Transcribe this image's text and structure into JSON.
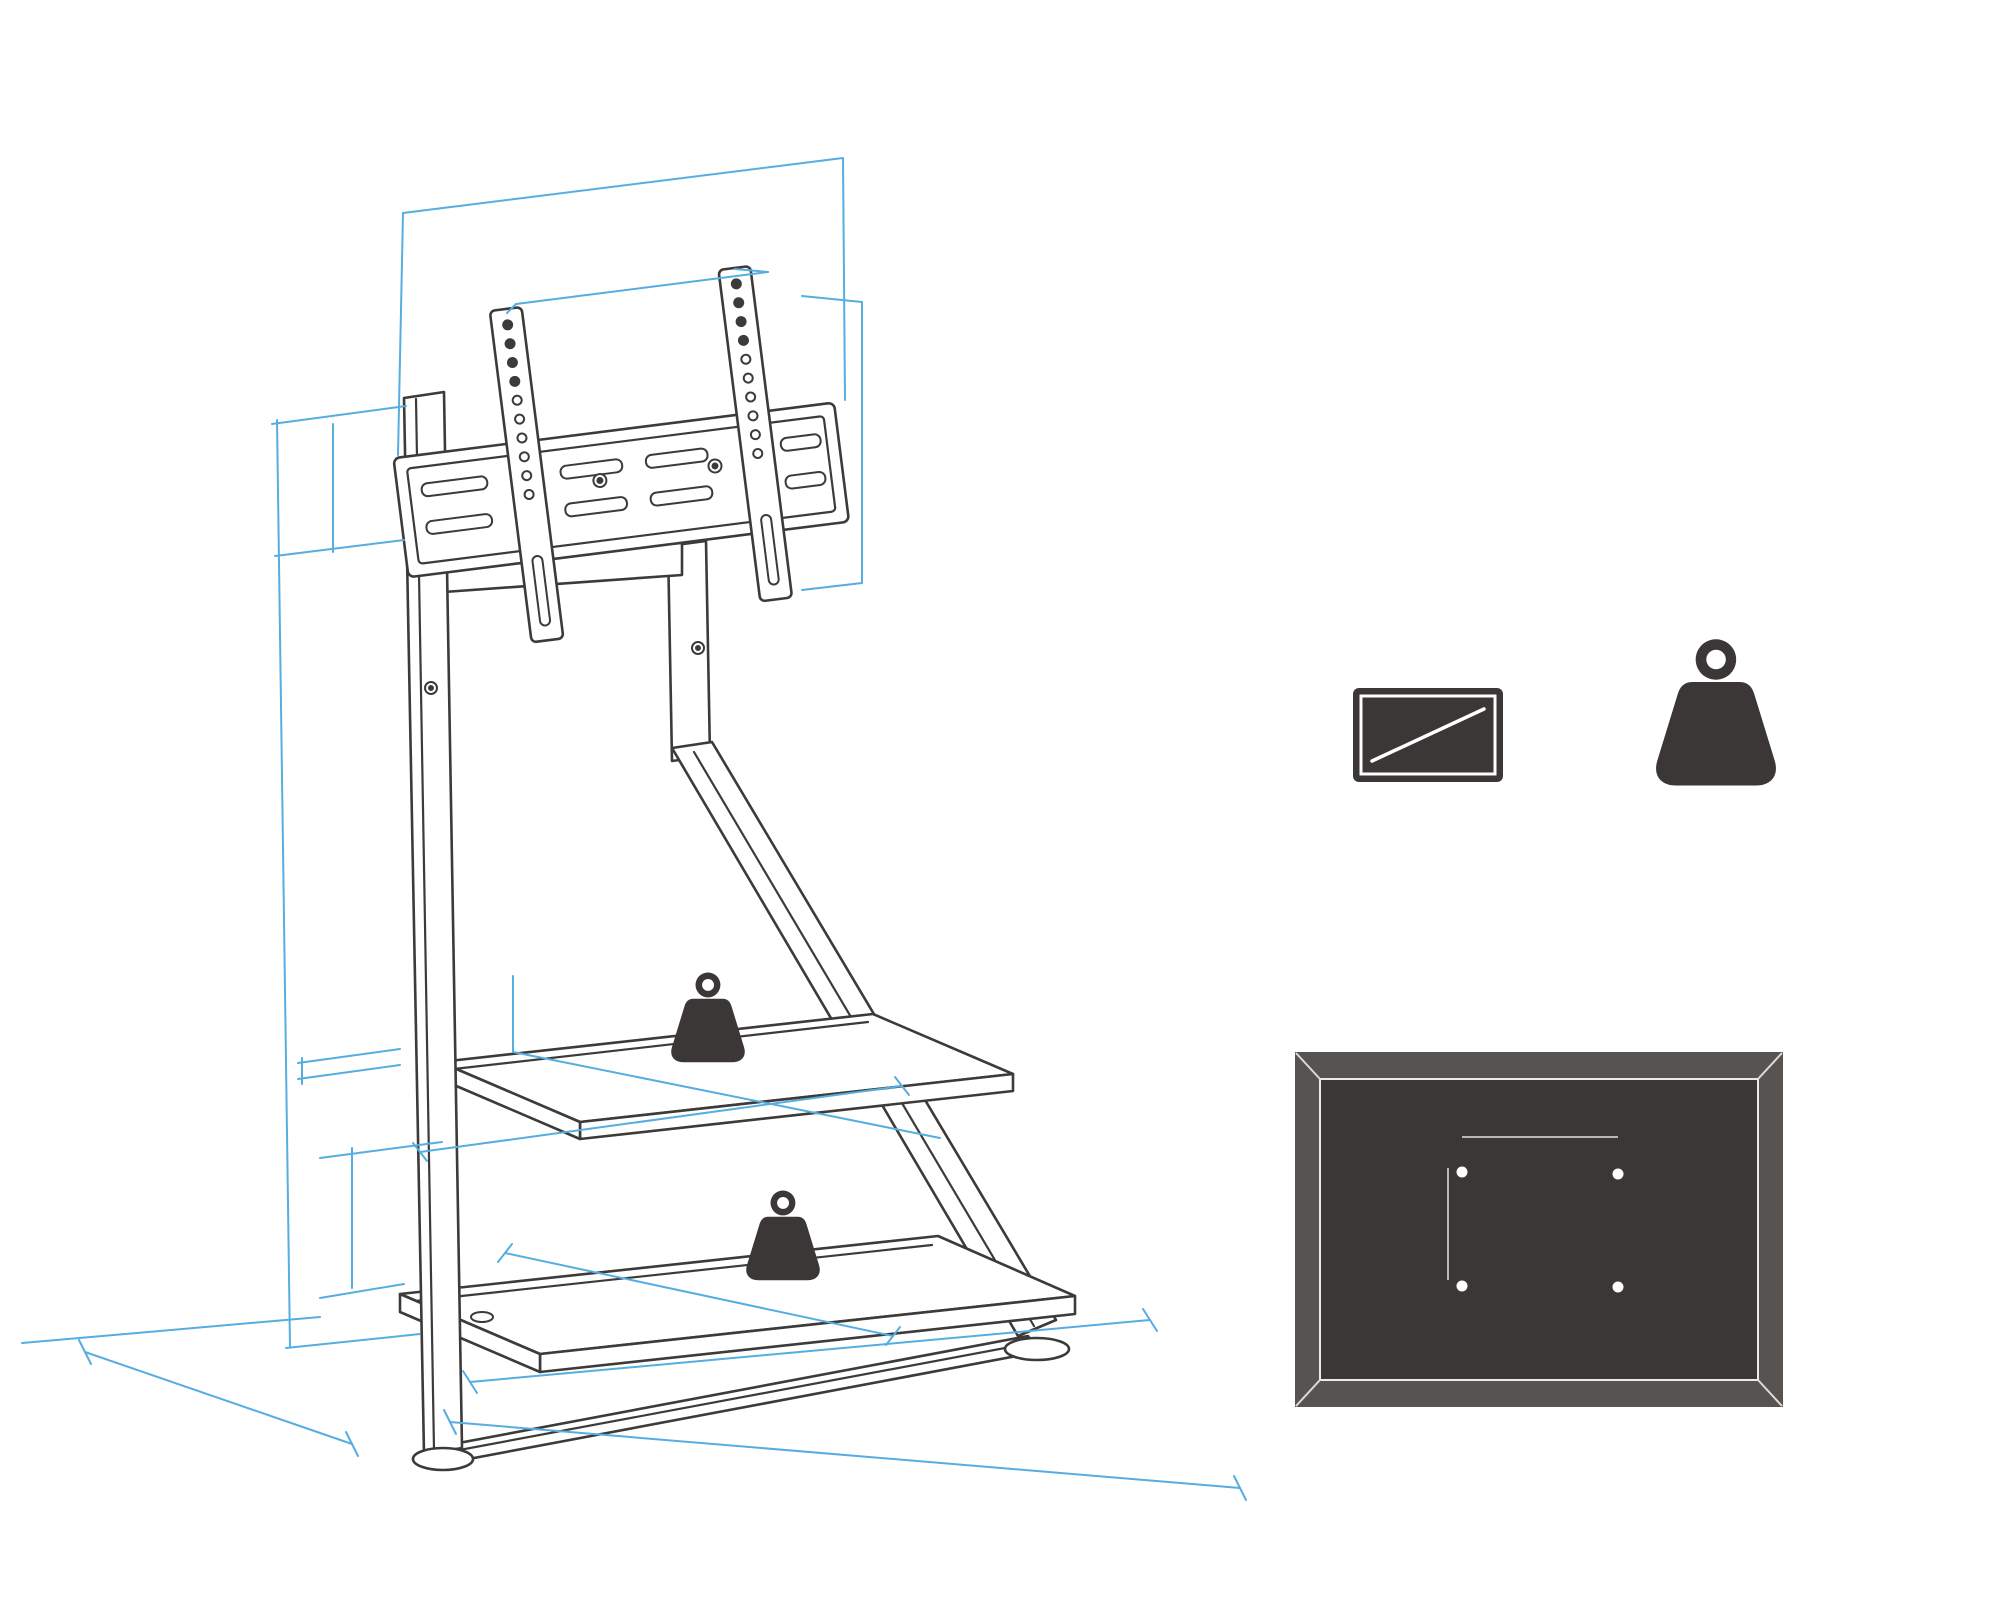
{
  "logo": {
    "brand": "FITUEYES",
    "registered": "®",
    "tagline": "FOR VISUAL ENJOYMENT"
  },
  "dims": {
    "top_width": {
      "inch": "25.6\"",
      "mm": "649MM"
    },
    "vesa_width": {
      "label": "VESA-Bereich(Breite)",
      "range": "100MM - 600MM"
    },
    "vesa_height": {
      "label": "VESA-Bereich(Höhe)",
      "range": "100MM - 400MM"
    },
    "bracket_height": {
      "inch": "6.6\"",
      "mm": "168MM"
    },
    "stand_height": {
      "min_inch": "51.5\"",
      "min_mm": "1307MM",
      "separator": "—",
      "max_inch": "57.6\"",
      "max_mm": "1463MM"
    },
    "shelf_thickness": {
      "inch": "0.7\"",
      "mm": "18MM"
    },
    "mid_shelf_depth": {
      "inch": "11.0\"",
      "mm": "280MM"
    },
    "mid_shelf_width": {
      "inch": "27.0\"",
      "mm": "687MM"
    },
    "shelf_gap": {
      "inch": "11.0\"",
      "mm": "280MM"
    },
    "bottom_shelf_depth": {
      "inch": "17.7\"",
      "mm": "450MM"
    },
    "base_depth": {
      "inch": "34.6\"",
      "mm": "880MM"
    },
    "base_width": {
      "inch": "38.0\"",
      "mm": "966MM"
    },
    "base_side": {
      "inch": "21.0\"",
      "mm": "534MM"
    }
  },
  "shelf_badge": {
    "max": "MAX",
    "kg": "15KGS",
    "lb": "33LBS"
  },
  "specs": {
    "tv_size_label": "43\"-75\"",
    "capacity": {
      "max": "MAX",
      "kg": "60KGS",
      "lb": "132LBS",
      "label": "Tragfähigkeit"
    }
  },
  "tv_back": {
    "title": "Rückseite des Fernsehers",
    "width_label": "VESA-Bereich(Breite)",
    "width_range": "100MM-600MM",
    "height_label": "VESA-Bereich(Höhe)",
    "height_range": "100MM-400MM"
  },
  "colors": {
    "dimension_line": "#56ade1",
    "line_art": "#3d3a39",
    "dark_fill": "#3a3736"
  }
}
